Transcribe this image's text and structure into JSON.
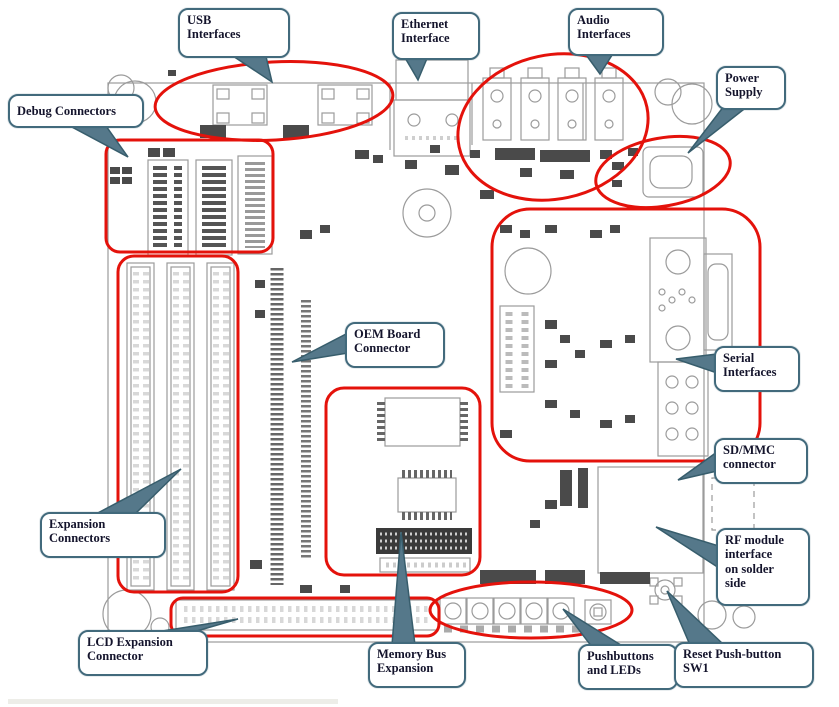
{
  "figure": {
    "title": "Development board annotated top view",
    "type": "pcb-callout-diagram",
    "colors": {
      "highlight_red": "#e4120b",
      "callout_border": "#426a7c",
      "callout_text": "#14142c",
      "board_line": "#9b9b9b"
    }
  },
  "callouts": [
    {
      "id": "usb",
      "label": "USB\nInterfaces"
    },
    {
      "id": "ethernet",
      "label": "Ethernet\nInterface"
    },
    {
      "id": "audio",
      "label": "Audio\nInterfaces"
    },
    {
      "id": "power",
      "label": "Power\nSupply"
    },
    {
      "id": "debug",
      "label": "Debug Connectors"
    },
    {
      "id": "oem",
      "label": "OEM Board\nConnector"
    },
    {
      "id": "serial",
      "label": "Serial\nInterfaces"
    },
    {
      "id": "sdmmc",
      "label": "SD/MMC\nconnector"
    },
    {
      "id": "rf",
      "label": "RF module\ninterface\non solder\nside"
    },
    {
      "id": "expansion",
      "label": "Expansion\nConnectors"
    },
    {
      "id": "lcd",
      "label": "LCD Expansion\nConnector"
    },
    {
      "id": "membus",
      "label": "Memory Bus\nExpansion"
    },
    {
      "id": "pushbuttons",
      "label": "Pushbuttons\nand LEDs"
    },
    {
      "id": "reset",
      "label": "Reset Push-button\nSW1"
    }
  ]
}
